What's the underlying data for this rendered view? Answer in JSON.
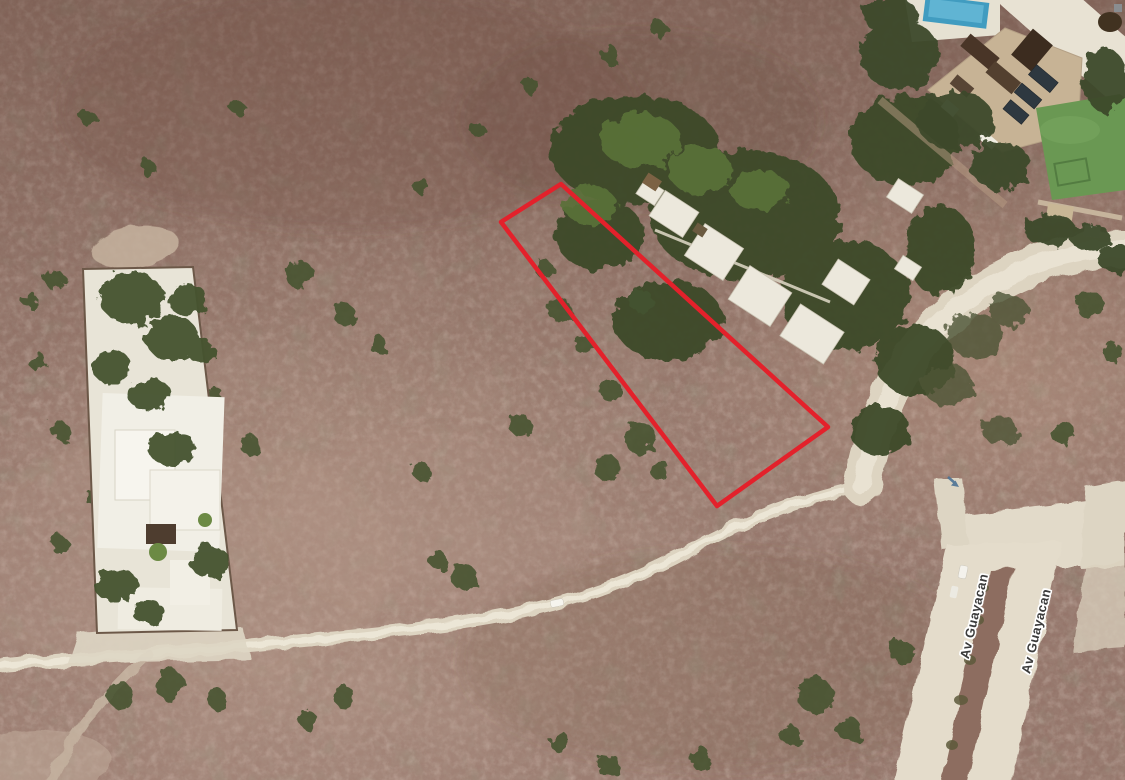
{
  "map": {
    "view": "satellite",
    "road_labels": [
      {
        "text": "Av Guayacan"
      },
      {
        "text": "Av Guayacan"
      }
    ],
    "annotation": {
      "polygon_points": "501,222 561,184 828,427 717,506",
      "stroke_color": "#e8202a"
    },
    "colors": {
      "terrain_base": "#96766a",
      "terrain_dark": "#6e4f43",
      "terrain_light": "#b2948a",
      "tree_green": "#3c4929",
      "road": "#e5ddcb",
      "pool_blue": "#3f9dc2",
      "lawn_green": "#699851",
      "label_text": "#3b3b3b",
      "label_halo": "#ffffff",
      "arrow_blue": "#4c7396"
    }
  }
}
